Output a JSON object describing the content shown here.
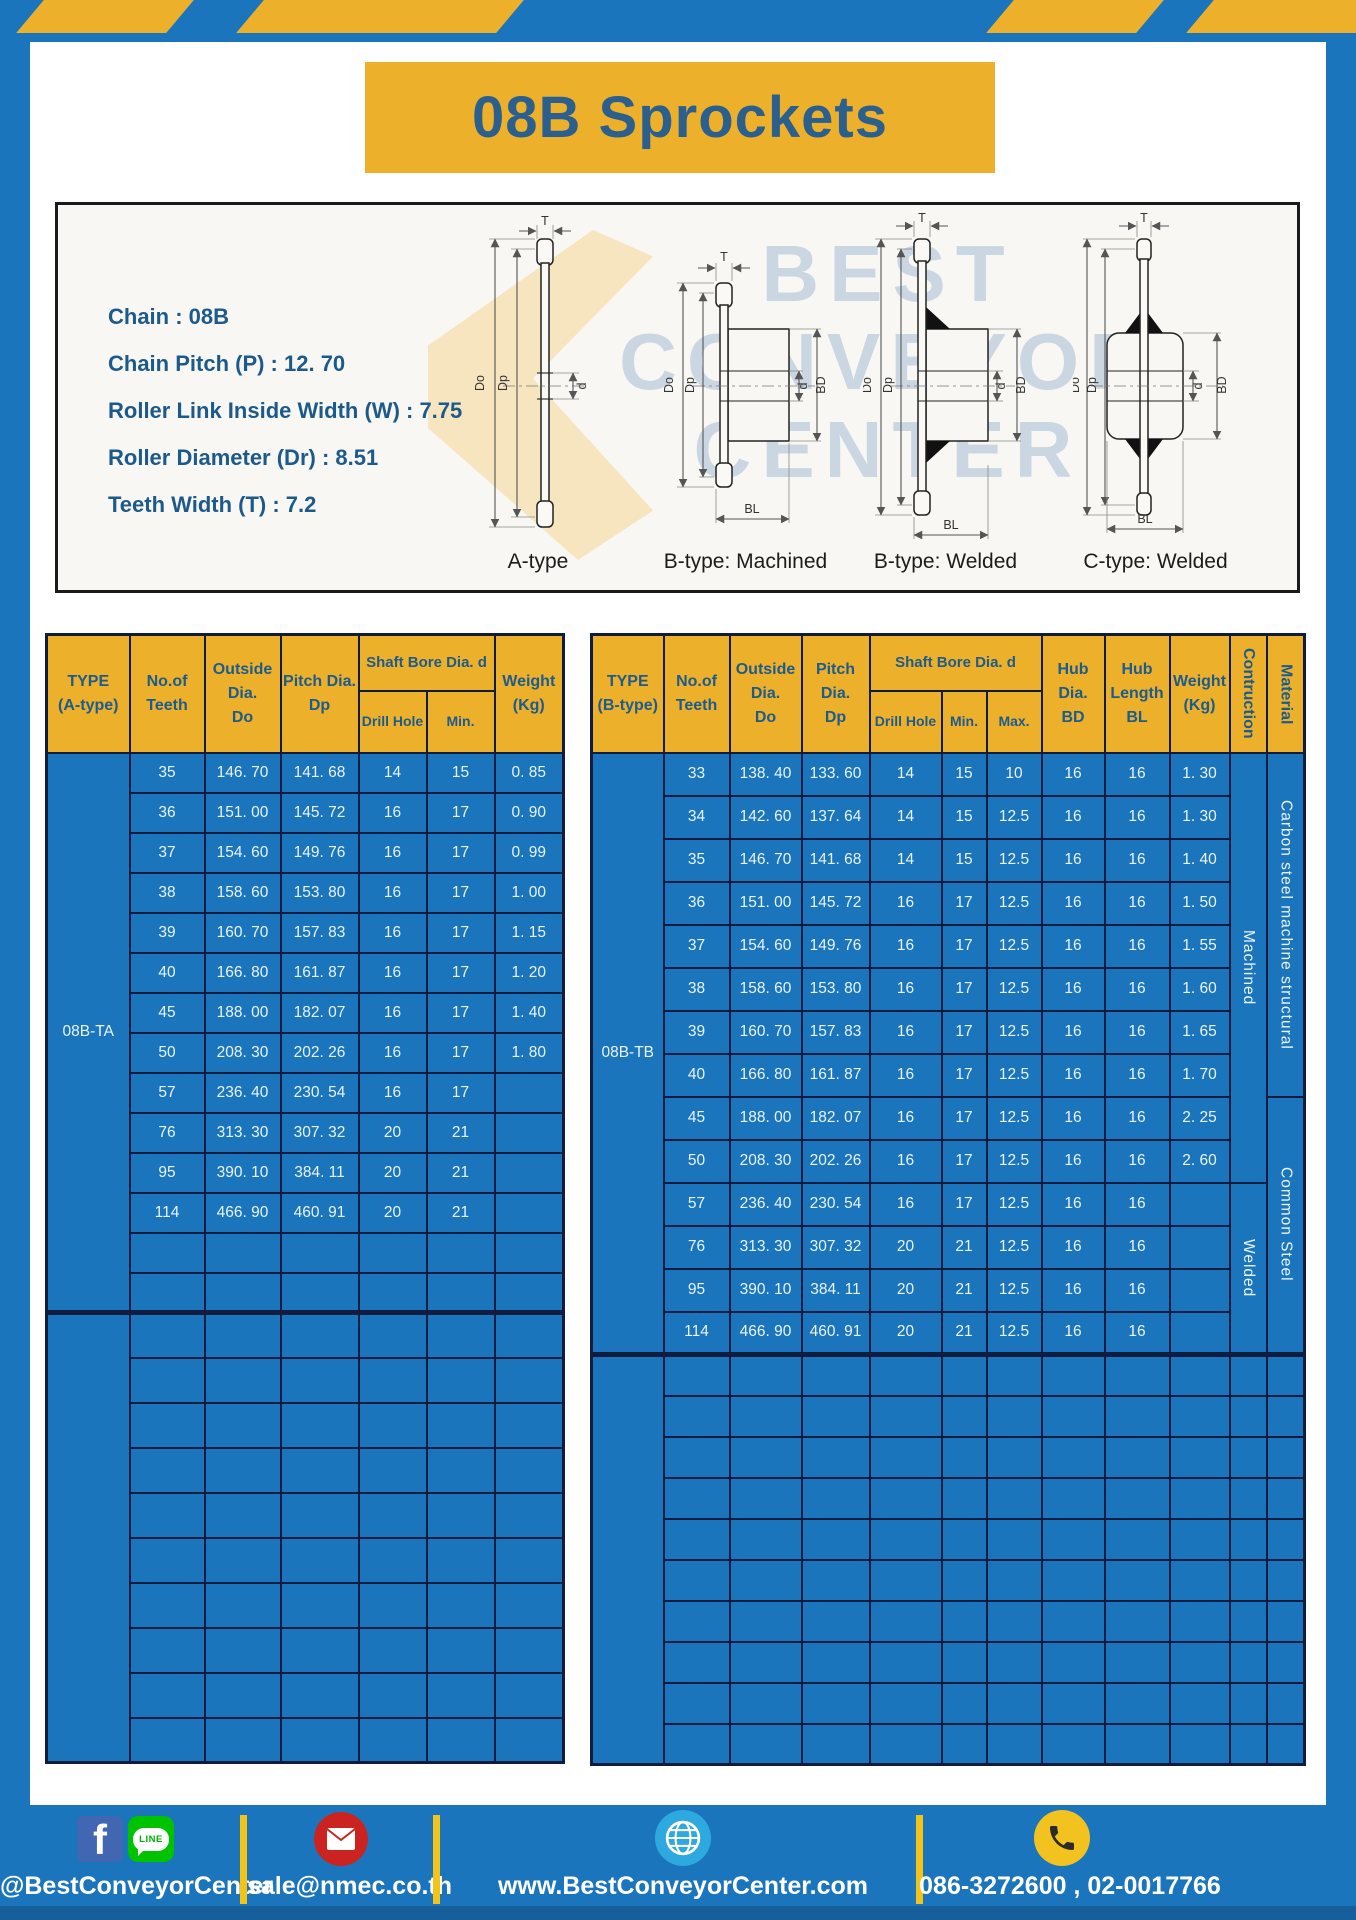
{
  "page": {
    "title": "08B Sprockets"
  },
  "colors": {
    "blue": "#1b75bc",
    "yellow": "#edb02a",
    "navy_border": "#0d1c3f",
    "header_text": "#1d5b8d",
    "cell_text": "#eaf4fd"
  },
  "specs": {
    "lines": [
      "Chain : 08B",
      "Chain Pitch (P) : 12. 70",
      "Roller Link Inside Width (W) : 7.75",
      "Roller Diameter (Dr) : 8.51",
      "Teeth Width (T) : 7.2"
    ]
  },
  "diagram": {
    "labels": [
      "A-type",
      "B-type: Machined",
      "B-type: Welded",
      "C-type: Welded"
    ],
    "dims": {
      "t": "T",
      "outer": "Do",
      "pitch": "Dp",
      "bore": "d",
      "hub": "BD",
      "hublen": "BL"
    },
    "watermark": {
      "line1": "BEST",
      "line2": "CONVEYOR",
      "line3": "CENTER"
    }
  },
  "table_a": {
    "headers": {
      "type": "TYPE\n(A-type)",
      "teeth": "No.of\nTeeth",
      "outside": "Outside\nDia.\nDo",
      "pitch": "Pitch Dia.\nDp",
      "shaft": "Shaft Bore Dia. d",
      "drill": "Drill Hole",
      "min": "Min.",
      "weight": "Weight\n(Kg)"
    },
    "type_label": "08B-TA",
    "rows": [
      [
        "35",
        "146. 70",
        "141. 68",
        "14",
        "15",
        "0. 85"
      ],
      [
        "36",
        "151. 00",
        "145. 72",
        "16",
        "17",
        "0. 90"
      ],
      [
        "37",
        "154. 60",
        "149. 76",
        "16",
        "17",
        "0. 99"
      ],
      [
        "38",
        "158. 60",
        "153. 80",
        "16",
        "17",
        "1. 00"
      ],
      [
        "39",
        "160. 70",
        "157. 83",
        "16",
        "17",
        "1. 15"
      ],
      [
        "40",
        "166. 80",
        "161. 87",
        "16",
        "17",
        "1. 20"
      ],
      [
        "45",
        "188. 00",
        "182. 07",
        "16",
        "17",
        "1. 40"
      ],
      [
        "50",
        "208. 30",
        "202. 26",
        "16",
        "17",
        "1. 80"
      ],
      [
        "57",
        "236. 40",
        "230. 54",
        "16",
        "17",
        ""
      ],
      [
        "76",
        "313. 30",
        "307. 32",
        "20",
        "21",
        ""
      ],
      [
        "95",
        "390. 10",
        "384. 11",
        "20",
        "21",
        ""
      ],
      [
        "114",
        "466. 90",
        "460. 91",
        "20",
        "21",
        ""
      ]
    ],
    "empty_rows_in_block": 2,
    "empty_rows_below": 10
  },
  "table_b": {
    "headers": {
      "type": "TYPE\n(B-type)",
      "teeth": "No.of\nTeeth",
      "outside": "Outside\nDia.\nDo",
      "pitch": "Pitch Dia.\nDp",
      "shaft": "Shaft Bore Dia. d",
      "drill": "Drill Hole",
      "min": "Min.",
      "max": "Max.",
      "hub_dia": "Hub Dia.\nBD",
      "hub_len": "Hub\nLength\nBL",
      "weight": "Weight\n(Kg)",
      "construction": "Contruction",
      "material": "Material"
    },
    "type_label": "08B-TB",
    "rows": [
      [
        "33",
        "138. 40",
        "133. 60",
        "14",
        "15",
        "10",
        "16",
        "16",
        "1. 30"
      ],
      [
        "34",
        "142. 60",
        "137. 64",
        "14",
        "15",
        "12.5",
        "16",
        "16",
        "1. 30"
      ],
      [
        "35",
        "146. 70",
        "141. 68",
        "14",
        "15",
        "12.5",
        "16",
        "16",
        "1. 40"
      ],
      [
        "36",
        "151. 00",
        "145. 72",
        "16",
        "17",
        "12.5",
        "16",
        "16",
        "1. 50"
      ],
      [
        "37",
        "154. 60",
        "149. 76",
        "16",
        "17",
        "12.5",
        "16",
        "16",
        "1. 55"
      ],
      [
        "38",
        "158. 60",
        "153. 80",
        "16",
        "17",
        "12.5",
        "16",
        "16",
        "1. 60"
      ],
      [
        "39",
        "160. 70",
        "157. 83",
        "16",
        "17",
        "12.5",
        "16",
        "16",
        "1. 65"
      ],
      [
        "40",
        "166. 80",
        "161. 87",
        "16",
        "17",
        "12.5",
        "16",
        "16",
        "1. 70"
      ],
      [
        "45",
        "188. 00",
        "182. 07",
        "16",
        "17",
        "12.5",
        "16",
        "16",
        "2. 25"
      ],
      [
        "50",
        "208. 30",
        "202. 26",
        "16",
        "17",
        "12.5",
        "16",
        "16",
        "2. 60"
      ],
      [
        "57",
        "236. 40",
        "230. 54",
        "16",
        "17",
        "12.5",
        "16",
        "16",
        ""
      ],
      [
        "76",
        "313. 30",
        "307. 32",
        "20",
        "21",
        "12.5",
        "16",
        "16",
        ""
      ],
      [
        "95",
        "390. 10",
        "384. 11",
        "20",
        "21",
        "12.5",
        "16",
        "16",
        ""
      ],
      [
        "114",
        "466. 90",
        "460. 91",
        "20",
        "21",
        "12.5",
        "16",
        "16",
        ""
      ]
    ],
    "construction_blocks": [
      {
        "label": "Machined",
        "rows": 10
      },
      {
        "label": "Welded",
        "rows": 4
      }
    ],
    "material_blocks": [
      {
        "label": "Carbon steel  machine structural",
        "rows": 8
      },
      {
        "label": "Common Steel",
        "rows": 6
      }
    ],
    "empty_rows_below": 10
  },
  "footer": {
    "line_label": "LINE",
    "social": "@BestConveyorCenter",
    "email": "sale@nmec.co.th",
    "website": "www.BestConveyorCenter.com",
    "phones": "086-3272600 , 02-0017766"
  }
}
